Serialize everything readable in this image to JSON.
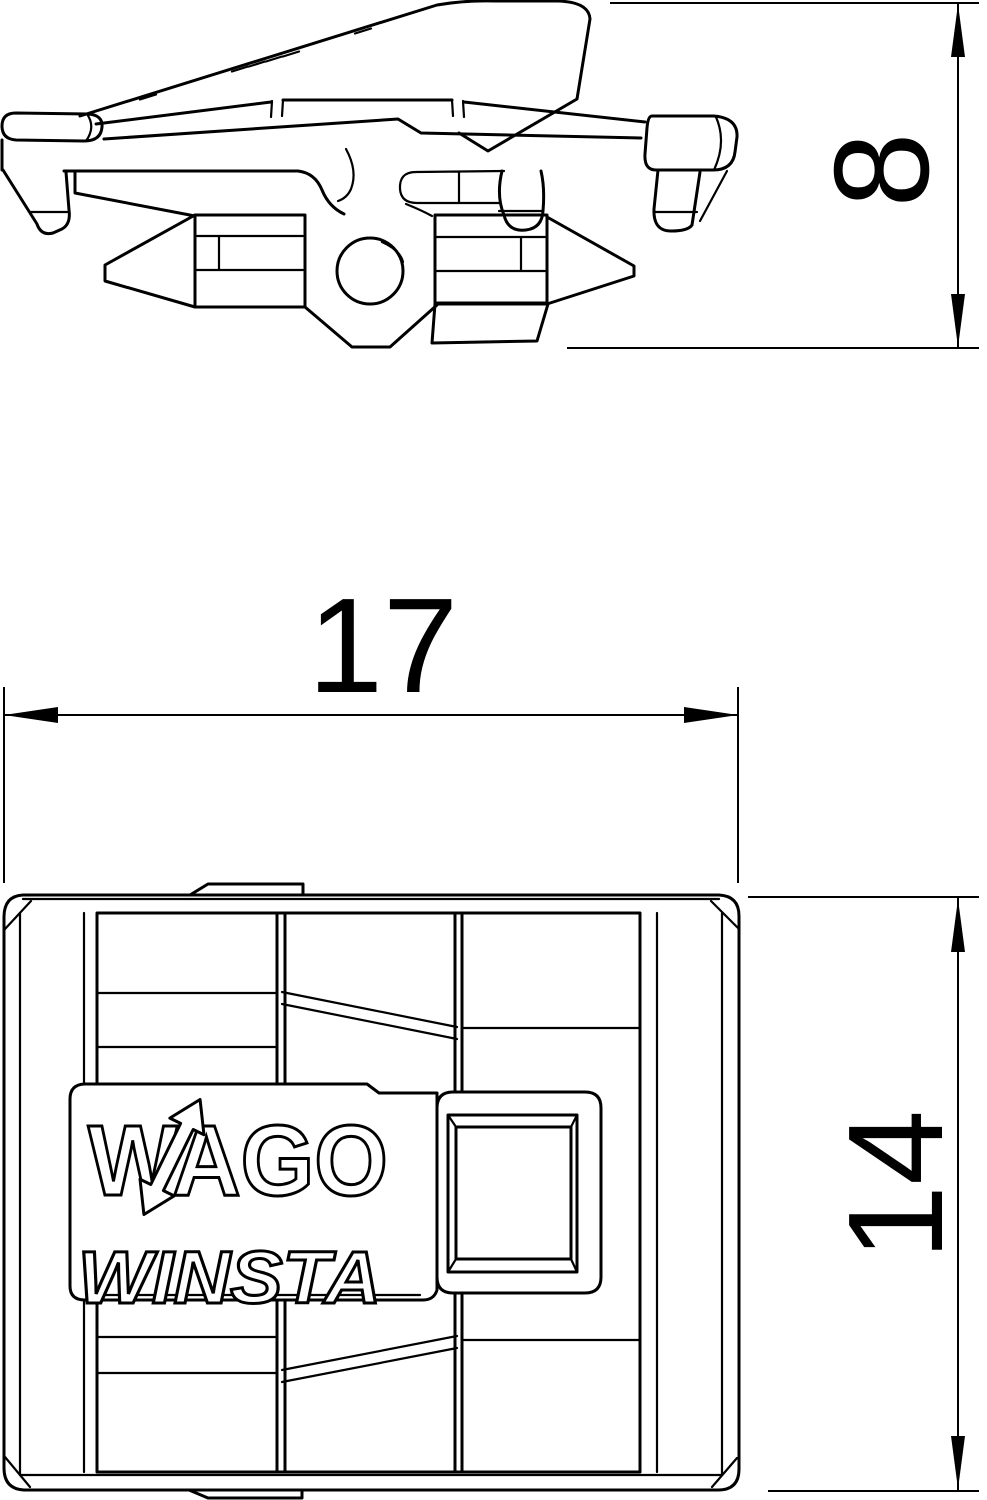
{
  "colors": {
    "line": "#000000",
    "background": "#ffffff"
  },
  "front_view": {
    "logo_brand": "WAGO",
    "logo_series": "WINSTA"
  },
  "dimensions": {
    "side_height": "8",
    "front_width": "17",
    "front_height": "14"
  }
}
